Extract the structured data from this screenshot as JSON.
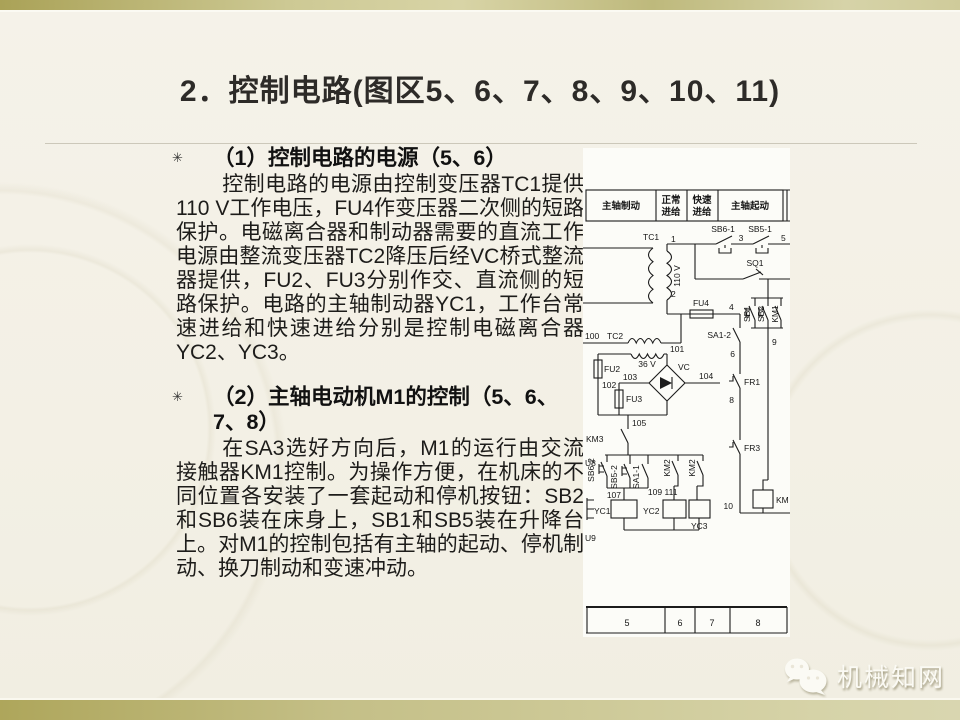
{
  "slide": {
    "title": "2．控制电路(图区5、6、7、8、9、10、11)",
    "bullets": [
      {
        "marker": "✳",
        "heading": "（1）控制电路的电源（5、6）",
        "body": "控制电路的电源由控制变压器TC1提供110 V工作电压，FU4作变压器二次侧的短路保护。电磁离合器和制动器需要的直流工作电源由整流变压器TC2降压后经VC桥式整流器提供，FU2、FU3分别作交、直流侧的短路保护。电路的主轴制动器YC1，工作台常速进给和快速进给分别是控制电磁离合器YC2、YC3。"
      },
      {
        "marker": "✳",
        "heading": "（2）主轴电动机M1的控制（5、6、7、8）",
        "body": "在SA3选好方向后，M1的运行由交流接触器KM1控制。为操作方便，在机床的不同位置各安装了一套起动和停机按钮：SB2和SB6装在床身上，SB1和SB5装在升降台上。对M1的控制包括有主轴的起动、停机制动、换刀制动和变速冲动。"
      }
    ]
  },
  "diagram": {
    "header": [
      [
        "主轴制动"
      ],
      [
        "正常",
        "进给"
      ],
      [
        "快速",
        "进给"
      ],
      [
        "主轴起动"
      ]
    ],
    "zones": [
      "5",
      "6",
      "7",
      "8"
    ],
    "labels": {
      "tc1": "TC1",
      "n1": "1",
      "n2": "2",
      "v110": "110 V",
      "fu4": "FU4",
      "n4": "4",
      "sb6_1": "SB6-1",
      "n3": "3",
      "sb5_1": "SB5-1",
      "n5": "5",
      "sq1": "SQ1",
      "n100": "100",
      "tc2": "TC2",
      "v36": "36 V",
      "n101": "101",
      "fu2": "FU2",
      "n102": "102",
      "n103": "103",
      "fu3": "FU3",
      "vc": "VC",
      "n104": "104",
      "sa1_2": "SA1-2",
      "n6": "6",
      "fr1": "FR1",
      "n8": "8",
      "fr3": "FR3",
      "sb1": "SB1",
      "sb2": "SB2",
      "km1": "KM1",
      "n9": "9",
      "km": "KM",
      "n10": "10",
      "km3": "KM3",
      "n105": "105",
      "sb6_2": "SB6-2",
      "sb5_2": "SB5-2",
      "sa1_1": "SA1-1",
      "km2a": "KM2",
      "km2b": "KM2",
      "n107": "107",
      "n109": "109",
      "n111": "111",
      "yc1": "YC1",
      "yc2": "YC2",
      "yc3": "YC3",
      "u8": "U8",
      "u9": "U9"
    }
  },
  "footer": {
    "brand": "机械知网"
  },
  "colors": {
    "band": "#aea65b",
    "slide_bg": "#f3f0e5",
    "text": "#1d1c1a",
    "diagram_bg": "#fcfcf8",
    "brand_text": "#fbfaf4"
  }
}
